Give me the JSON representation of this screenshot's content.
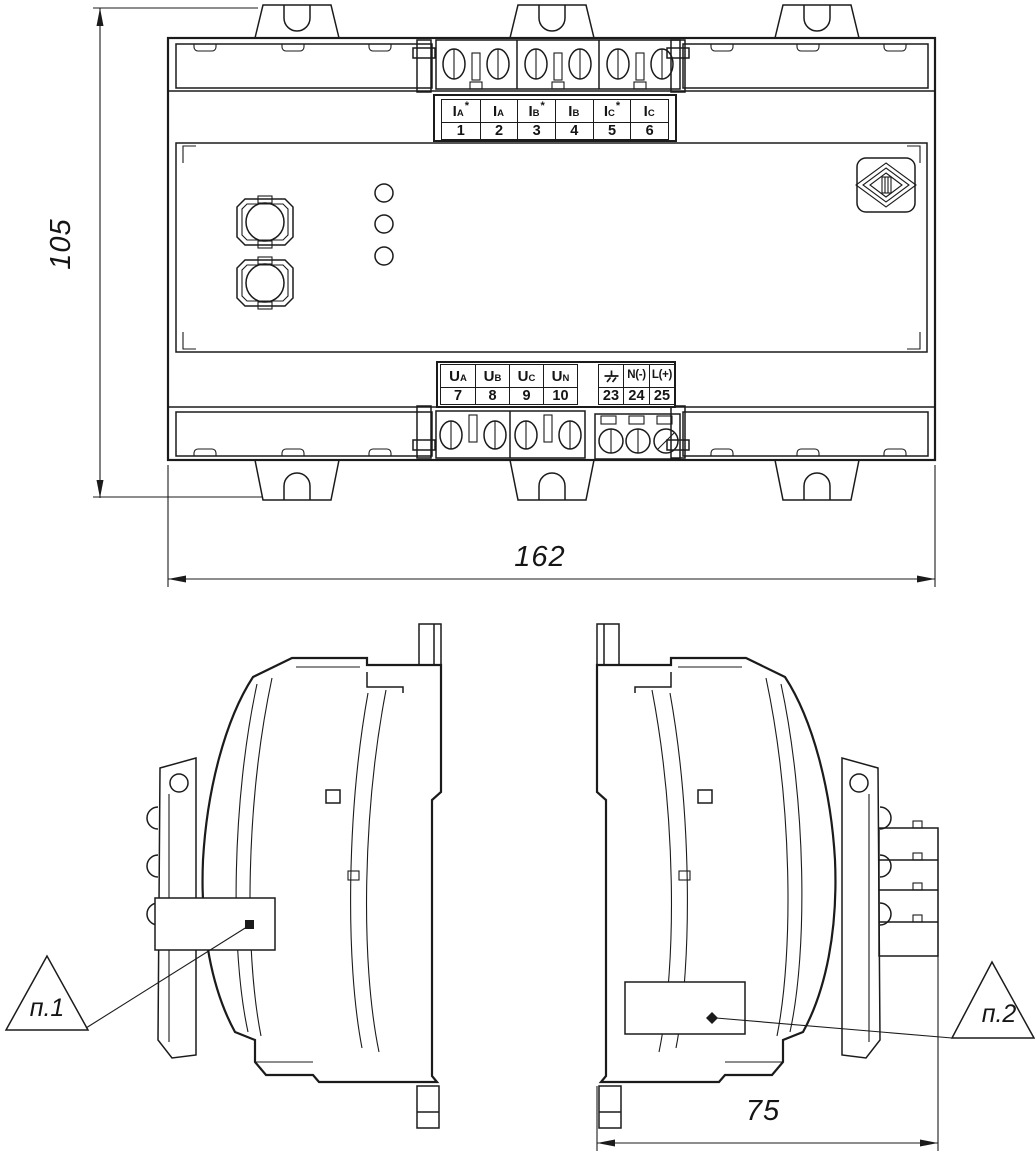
{
  "drawing_type": "engineering-dimension-drawing",
  "colors": {
    "line": "#1b1b1b",
    "background": "#ffffff"
  },
  "dimensions": {
    "height_mm": "105",
    "width_mm": "162",
    "depth_mm": "75"
  },
  "callouts": {
    "item1": "п.1",
    "item2": "п.2"
  },
  "icons": {
    "ground": "earth-ground-icon",
    "logo": "manufacturer-diamond-logo"
  },
  "current_terminals": {
    "cells": [
      {
        "main": "I",
        "sub": "A",
        "star": "*",
        "num": "1"
      },
      {
        "main": "I",
        "sub": "A",
        "star": "",
        "num": "2"
      },
      {
        "main": "I",
        "sub": "B",
        "star": "*",
        "num": "3"
      },
      {
        "main": "I",
        "sub": "B",
        "star": "",
        "num": "4"
      },
      {
        "main": "I",
        "sub": "C",
        "star": "*",
        "num": "5"
      },
      {
        "main": "I",
        "sub": "C",
        "star": "",
        "num": "6"
      }
    ]
  },
  "voltage_terminals": {
    "cells": [
      {
        "main": "U",
        "sub": "A",
        "num": "7"
      },
      {
        "main": "U",
        "sub": "B",
        "num": "8"
      },
      {
        "main": "U",
        "sub": "C",
        "num": "9"
      },
      {
        "main": "U",
        "sub": "N",
        "num": "10"
      }
    ]
  },
  "power_terminals": {
    "cells": [
      {
        "icon": "earth-ground-icon",
        "label": "",
        "num": "23"
      },
      {
        "label": "N(-)",
        "num": "24"
      },
      {
        "label": "L(+)",
        "num": "25"
      }
    ]
  }
}
